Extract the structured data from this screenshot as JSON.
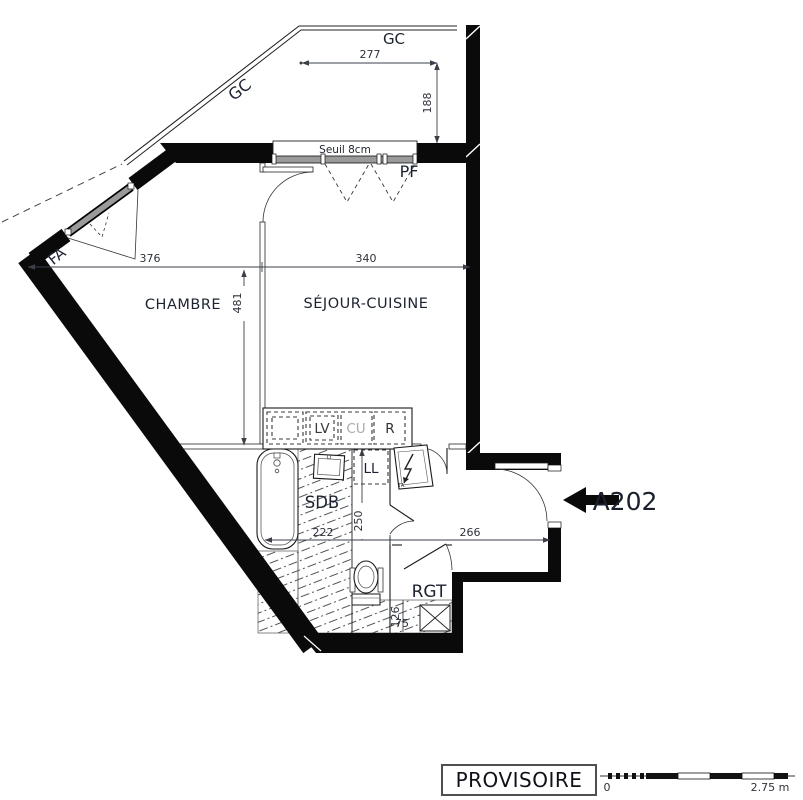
{
  "plan": {
    "unit": {
      "label": "A202"
    },
    "stamp": {
      "label": "PROVISOIRE"
    },
    "rooms": {
      "chambre": "CHAMBRE",
      "sejour_cuisine": "SÉJOUR-CUISINE",
      "sdb": "SDB",
      "rgt": "RGT"
    },
    "openings": {
      "gc_top": "GC",
      "gc_diagonal": "GC",
      "fa": "FA",
      "pf": "PF",
      "seuil": "Seuil 8cm"
    },
    "equipment": {
      "lv": "LV",
      "cu": "CU",
      "r": "R",
      "ll": "LL",
      "ta": "TA."
    },
    "dimensions_cm": {
      "balcony_width": "277",
      "balcony_depth": "188",
      "chambre_width": "376",
      "sejour_width": "340",
      "chambre_depth": "481",
      "sdb_depth": "250",
      "sdb_width": "222",
      "entry_width": "266",
      "rgt_depth": "126",
      "rgt_closet": "75"
    },
    "scale_bar": {
      "start": "0",
      "end": "2.75 m"
    },
    "colors": {
      "wall": "#0a0a0a",
      "label_text": "#1d2230",
      "dim_text": "#2e323a",
      "glazing": "#9a9a9a",
      "cu_text": "#ababab"
    }
  }
}
